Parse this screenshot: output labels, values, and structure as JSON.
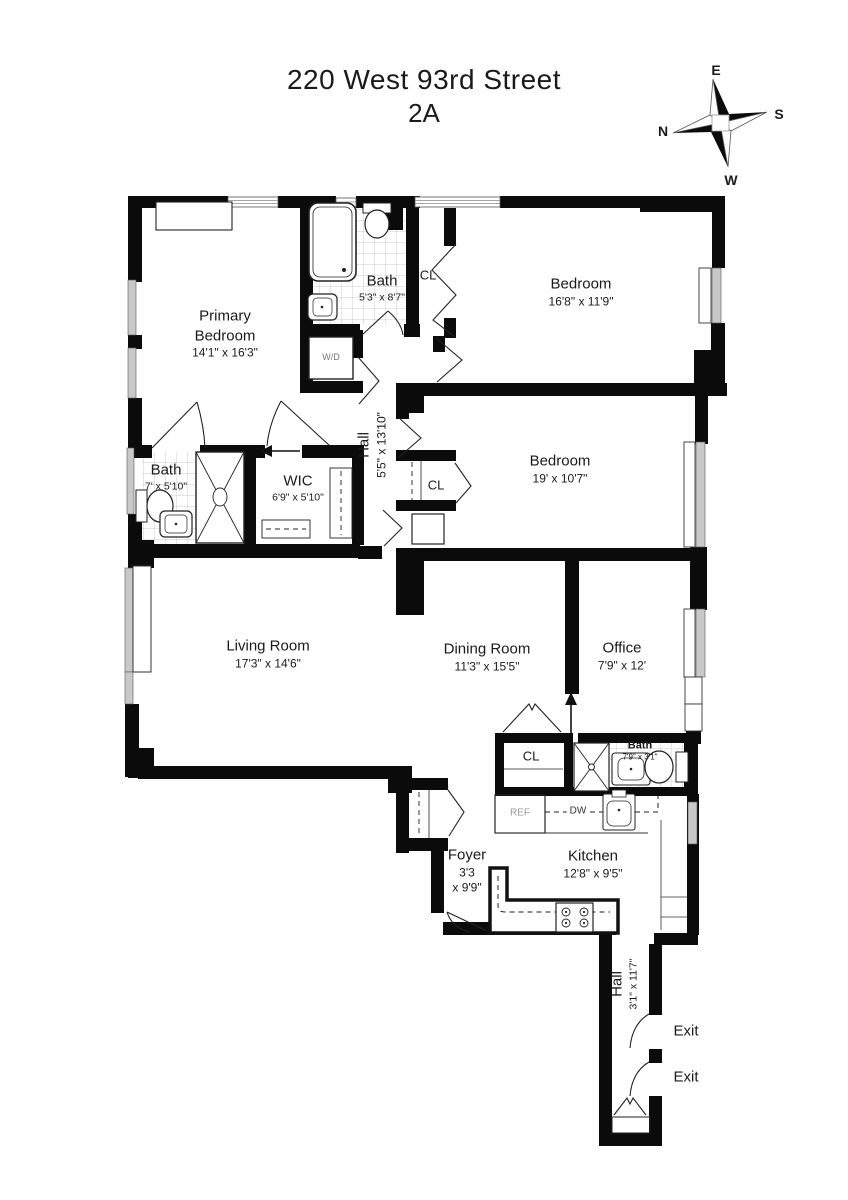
{
  "title": {
    "address": "220 West 93rd Street",
    "unit": "2A"
  },
  "compass": {
    "top": "E",
    "right": "S",
    "bottom": "W",
    "left": "N"
  },
  "rooms": {
    "primary_bedroom": {
      "name_line1": "Primary",
      "name_line2": "Bedroom",
      "dims": "14'1\" x 16'3\""
    },
    "bath_top": {
      "name": "Bath",
      "dims": "5'3\" x 8'7\""
    },
    "bedroom_top": {
      "name": "Bedroom",
      "dims": "16'8\" x 11'9\""
    },
    "hall_center": {
      "name": "Hall",
      "dims": "5'5\" x 13'10\""
    },
    "bedroom_mid": {
      "name": "Bedroom",
      "dims": "19' x 10'7\""
    },
    "bath_left": {
      "name": "Bath",
      "dims": "7' x 5'10\""
    },
    "wic": {
      "name": "WIC",
      "dims": "6'9\" x 5'10\""
    },
    "living_room": {
      "name": "Living Room",
      "dims": "17'3\" x 14'6\""
    },
    "dining_room": {
      "name": "Dining Room",
      "dims": "11'3\" x 15'5\""
    },
    "office": {
      "name": "Office",
      "dims": "7'9\" x 12'"
    },
    "bath_small": {
      "name": "Bath",
      "dims": "7'9\" x 3'1\""
    },
    "foyer": {
      "name": "Foyer",
      "dims_line1": "3'3",
      "dims_line2": "x 9'9\""
    },
    "kitchen": {
      "name": "Kitchen",
      "dims": "12'8\" x 9'5\""
    },
    "hall_bottom": {
      "name": "Hall",
      "dims": "3'1\" x 11'7\""
    }
  },
  "labels": {
    "closet": "CL",
    "washer_dryer": "W/D",
    "refrigerator": "REF",
    "dishwasher": "DW",
    "exit": "Exit"
  },
  "colors": {
    "wall": "#0b0b0b",
    "window_glass": "#c8c8c8",
    "tile_line": "#bbbbbb",
    "fixture_line": "#222222",
    "text": "#1a1a1a"
  }
}
